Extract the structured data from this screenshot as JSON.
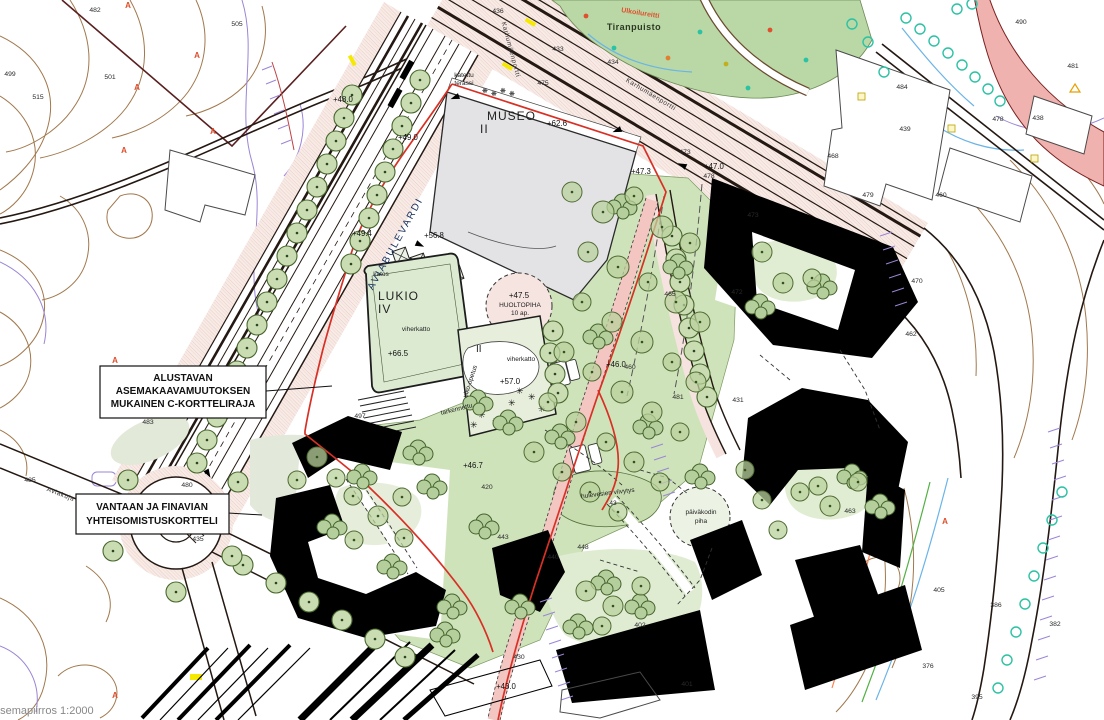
{
  "map": {
    "scale_text": "asemapiirros 1:2000",
    "boxes": {
      "c_kortteliraja": [
        "ALUSTAVAN",
        "ASEMAKAAVAMUUTOKSEN",
        "MUKAINEN C-KORTTELIRAJA"
      ],
      "yhteisomistus": [
        "VANTAAN JA FINAVIAN",
        "YHTEISOMISTUSKORTTELI"
      ]
    },
    "buildings": {
      "museo": {
        "name": "MUSEO",
        "floors": "II",
        "roof_elevation": "+62.6"
      },
      "lukio": {
        "name": "LUKIO",
        "floors": "IV",
        "roof": "viherkatto",
        "roof_elevation": "+66.5"
      },
      "annex": {
        "floors": "II",
        "roof": "viherkatto",
        "roof_elevation": "+57.0",
        "yard_label": "ulko-opetus",
        "note": "tarkennettu"
      },
      "huoltopiha": {
        "elevation": "+47.5",
        "name": "HUOLTOPIHA",
        "parking": "10 ap."
      }
    },
    "areas": {
      "park": "Tiranpuisto",
      "route": "Ulkoilureitti",
      "stormwater": "hulevesien viivytys",
      "stormwater_value": "43",
      "daycare_line1": "päiväkodin",
      "daycare_line2": "piha",
      "terrace_line1": "katettu",
      "terrace_line2": "terassi",
      "canopy": "katos"
    },
    "streets": {
      "aviabulevardi": "AVIABULEVARDI",
      "aviakuja": "Aviakuja",
      "karhumaenportti": "Karhumäenportti"
    },
    "colors": {
      "boundary_red": "#d93025",
      "path_pink": "#f3c6c2",
      "park_green": "#b9d8a6",
      "landscape_green": "#cfe3bb",
      "building_black": "#000000",
      "museum_gray": "#e3e3e5",
      "contour_brown": "#a1784c",
      "tree_teal": "#2cc2a4"
    },
    "elevations": [
      {
        "x": 641,
        "y": 174,
        "t": "+47.3"
      },
      {
        "x": 714,
        "y": 169,
        "t": "+47.0"
      },
      {
        "x": 434,
        "y": 238,
        "t": "+56.8"
      },
      {
        "x": 362,
        "y": 236,
        "t": "+49.4"
      },
      {
        "x": 343,
        "y": 102,
        "t": "+48.0"
      },
      {
        "x": 408,
        "y": 140,
        "t": "+49.0"
      },
      {
        "x": 473,
        "y": 468,
        "t": "+46.7"
      },
      {
        "x": 616,
        "y": 367,
        "t": "+46.0"
      },
      {
        "x": 506,
        "y": 689,
        "t": "+43.0"
      }
    ],
    "spot_heights": [
      {
        "x": 95,
        "y": 12,
        "t": "482"
      },
      {
        "x": 237,
        "y": 26,
        "t": "505"
      },
      {
        "x": 10,
        "y": 76,
        "t": "499"
      },
      {
        "x": 38,
        "y": 99,
        "t": "515"
      },
      {
        "x": 110,
        "y": 79,
        "t": "501"
      },
      {
        "x": 148,
        "y": 424,
        "t": "483"
      },
      {
        "x": 30,
        "y": 482,
        "t": "485"
      },
      {
        "x": 187,
        "y": 487,
        "t": "480"
      },
      {
        "x": 198,
        "y": 541,
        "t": "435"
      },
      {
        "x": 902,
        "y": 89,
        "t": "484"
      },
      {
        "x": 905,
        "y": 131,
        "t": "439"
      },
      {
        "x": 998,
        "y": 121,
        "t": "478"
      },
      {
        "x": 833,
        "y": 158,
        "t": "468"
      },
      {
        "x": 868,
        "y": 197,
        "t": "479"
      },
      {
        "x": 941,
        "y": 197,
        "t": "460"
      },
      {
        "x": 1073,
        "y": 68,
        "t": "481"
      },
      {
        "x": 1021,
        "y": 24,
        "t": "490"
      },
      {
        "x": 753,
        "y": 217,
        "t": "473"
      },
      {
        "x": 737,
        "y": 294,
        "t": "472"
      },
      {
        "x": 917,
        "y": 283,
        "t": "470"
      },
      {
        "x": 911,
        "y": 336,
        "t": "462"
      },
      {
        "x": 685,
        "y": 154,
        "t": "473"
      },
      {
        "x": 709,
        "y": 178,
        "t": "478"
      },
      {
        "x": 670,
        "y": 296,
        "t": "465"
      },
      {
        "x": 678,
        "y": 399,
        "t": "481"
      },
      {
        "x": 738,
        "y": 402,
        "t": "431"
      },
      {
        "x": 850,
        "y": 513,
        "t": "463"
      },
      {
        "x": 583,
        "y": 549,
        "t": "448"
      },
      {
        "x": 553,
        "y": 559,
        "t": "440"
      },
      {
        "x": 503,
        "y": 539,
        "t": "443"
      },
      {
        "x": 487,
        "y": 489,
        "t": "420"
      },
      {
        "x": 360,
        "y": 418,
        "t": "497"
      },
      {
        "x": 630,
        "y": 369,
        "t": "460"
      },
      {
        "x": 519,
        "y": 659,
        "t": "430"
      },
      {
        "x": 640,
        "y": 627,
        "t": "402"
      },
      {
        "x": 687,
        "y": 686,
        "t": "401"
      },
      {
        "x": 939,
        "y": 592,
        "t": "405"
      },
      {
        "x": 996,
        "y": 607,
        "t": "386"
      },
      {
        "x": 1055,
        "y": 626,
        "t": "382"
      },
      {
        "x": 928,
        "y": 668,
        "t": "376"
      },
      {
        "x": 977,
        "y": 699,
        "t": "395"
      },
      {
        "x": 543,
        "y": 85,
        "t": "475"
      },
      {
        "x": 558,
        "y": 51,
        "t": "433"
      },
      {
        "x": 613,
        "y": 64,
        "t": "434"
      },
      {
        "x": 498,
        "y": 13,
        "t": "436"
      },
      {
        "x": 1038,
        "y": 120,
        "t": "438"
      }
    ],
    "trees": {
      "street": [
        [
          352,
          95
        ],
        [
          344,
          118
        ],
        [
          336,
          141
        ],
        [
          327,
          164
        ],
        [
          317,
          187
        ],
        [
          307,
          210
        ],
        [
          297,
          233
        ],
        [
          287,
          256
        ],
        [
          277,
          279
        ],
        [
          267,
          302
        ],
        [
          257,
          325
        ],
        [
          247,
          348
        ],
        [
          237,
          371
        ],
        [
          227,
          394
        ],
        [
          217,
          417
        ],
        [
          207,
          440
        ],
        [
          197,
          463
        ],
        [
          420,
          80
        ],
        [
          411,
          103
        ],
        [
          402,
          126
        ],
        [
          393,
          149
        ],
        [
          385,
          172
        ],
        [
          377,
          195
        ],
        [
          369,
          218
        ],
        [
          360,
          241
        ],
        [
          351,
          264
        ],
        [
          243,
          565
        ],
        [
          276,
          583
        ],
        [
          309,
          602
        ],
        [
          342,
          620
        ],
        [
          375,
          639
        ],
        [
          405,
          657
        ],
        [
          238,
          482
        ],
        [
          128,
          480
        ],
        [
          113,
          551
        ],
        [
          176,
          592
        ],
        [
          232,
          556
        ],
        [
          672,
          236
        ],
        [
          676,
          259
        ],
        [
          680,
          282
        ],
        [
          684,
          305
        ],
        [
          689,
          328
        ],
        [
          694,
          351
        ],
        [
          700,
          374
        ],
        [
          707,
          397
        ],
        [
          553,
          331
        ],
        [
          550,
          353
        ],
        [
          555,
          374
        ],
        [
          558,
          393
        ]
      ],
      "landscape": [
        [
          572,
          192,
          10
        ],
        [
          603,
          212,
          11
        ],
        [
          634,
          196,
          9
        ],
        [
          662,
          227,
          11
        ],
        [
          690,
          243,
          10
        ],
        [
          588,
          252,
          10
        ],
        [
          618,
          267,
          11
        ],
        [
          648,
          282,
          9
        ],
        [
          676,
          302,
          11
        ],
        [
          700,
          322,
          10
        ],
        [
          582,
          302,
          9
        ],
        [
          612,
          322,
          10
        ],
        [
          642,
          342,
          11
        ],
        [
          672,
          362,
          9
        ],
        [
          696,
          382,
          10
        ],
        [
          564,
          352,
          10
        ],
        [
          592,
          372,
          9
        ],
        [
          622,
          392,
          11
        ],
        [
          652,
          412,
          10
        ],
        [
          680,
          432,
          9
        ],
        [
          548,
          402,
          9
        ],
        [
          576,
          422,
          10
        ],
        [
          606,
          442,
          9
        ],
        [
          634,
          462,
          10
        ],
        [
          660,
          482,
          9
        ],
        [
          534,
          452,
          10
        ],
        [
          562,
          472,
          9
        ],
        [
          590,
          492,
          10
        ],
        [
          618,
          512,
          9
        ],
        [
          762,
          252,
          10
        ],
        [
          783,
          283,
          10
        ],
        [
          812,
          278,
          9
        ],
        [
          800,
          492,
          9
        ],
        [
          830,
          506,
          10
        ],
        [
          858,
          482,
          9
        ],
        [
          586,
          591,
          10
        ],
        [
          613,
          606,
          10
        ],
        [
          641,
          586,
          9
        ],
        [
          602,
          626,
          9
        ],
        [
          353,
          496,
          9
        ],
        [
          378,
          516,
          10
        ],
        [
          404,
          538,
          9
        ],
        [
          354,
          540,
          9
        ],
        [
          402,
          497,
          9
        ],
        [
          317,
          457,
          10
        ],
        [
          297,
          480,
          9
        ],
        [
          336,
          478,
          9
        ],
        [
          745,
          470,
          9
        ],
        [
          762,
          500,
          9
        ],
        [
          778,
          530,
          9
        ],
        [
          818,
          486,
          9
        ]
      ],
      "clusters": [
        [
          622,
          202
        ],
        [
          678,
          262
        ],
        [
          598,
          332
        ],
        [
          648,
          422
        ],
        [
          700,
          472
        ],
        [
          560,
          432
        ],
        [
          484,
          522
        ],
        [
          432,
          482
        ],
        [
          362,
          472
        ],
        [
          332,
          522
        ],
        [
          392,
          562
        ],
        [
          452,
          602
        ],
        [
          520,
          602
        ],
        [
          578,
          622
        ],
        [
          640,
          602
        ],
        [
          760,
          302
        ],
        [
          822,
          282
        ],
        [
          852,
          472
        ],
        [
          880,
          502
        ],
        [
          478,
          398
        ],
        [
          508,
          418
        ],
        [
          418,
          448
        ],
        [
          445,
          630
        ],
        [
          606,
          578
        ]
      ],
      "teal": [
        [
          906,
          18
        ],
        [
          920,
          29
        ],
        [
          934,
          41
        ],
        [
          948,
          53
        ],
        [
          962,
          65
        ],
        [
          975,
          77
        ],
        [
          988,
          89
        ],
        [
          1000,
          101
        ],
        [
          957,
          9
        ],
        [
          972,
          4
        ],
        [
          868,
          42
        ],
        [
          852,
          24
        ],
        [
          884,
          72
        ],
        [
          1062,
          492
        ],
        [
          1052,
          520
        ],
        [
          1043,
          548
        ],
        [
          1034,
          576
        ],
        [
          1025,
          604
        ],
        [
          1016,
          632
        ],
        [
          1007,
          660
        ],
        [
          998,
          688
        ]
      ]
    },
    "symbols": {
      "red_trees": [
        {
          "x": 128,
          "y": 8
        },
        {
          "x": 197,
          "y": 58
        },
        {
          "x": 137,
          "y": 90
        },
        {
          "x": 124,
          "y": 153
        },
        {
          "x": 213,
          "y": 134
        },
        {
          "x": 115,
          "y": 363
        },
        {
          "x": 945,
          "y": 524
        },
        {
          "x": 115,
          "y": 698
        }
      ],
      "park_dots": [
        {
          "x": 586,
          "y": 16,
          "c": "#e05030"
        },
        {
          "x": 614,
          "y": 48,
          "c": "#2cc2a4"
        },
        {
          "x": 668,
          "y": 58,
          "c": "#e08030"
        },
        {
          "x": 700,
          "y": 32,
          "c": "#2cc2a4"
        },
        {
          "x": 726,
          "y": 64,
          "c": "#c0b020"
        },
        {
          "x": 748,
          "y": 88,
          "c": "#2cc2a4"
        },
        {
          "x": 770,
          "y": 30,
          "c": "#e05030"
        },
        {
          "x": 806,
          "y": 60,
          "c": "#2cc2a4"
        }
      ]
    }
  }
}
